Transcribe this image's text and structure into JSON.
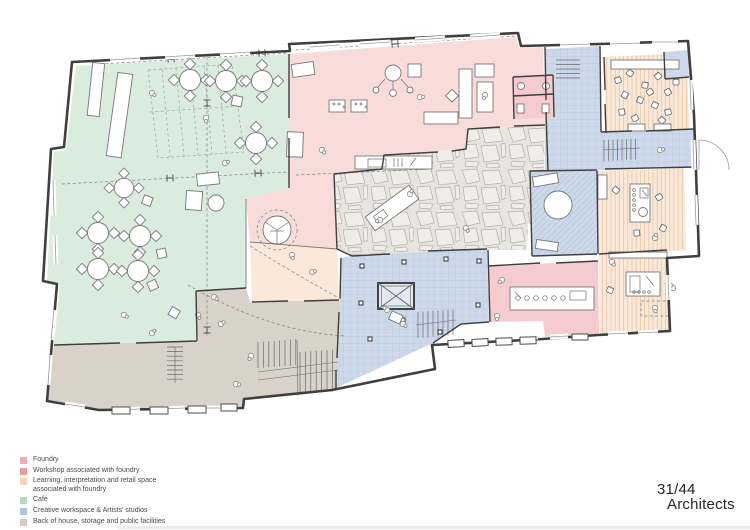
{
  "credit": {
    "line1": "31/44",
    "line2": "Architects"
  },
  "legend": {
    "items": [
      {
        "label": "Foundry",
        "color": "#efadad"
      },
      {
        "label": "Workshop associated with foundry",
        "color": "#e79e9e"
      },
      {
        "label": "Learning, interpretation and retail space",
        "label2": "associated with foundry",
        "color": "#f6d3ba"
      },
      {
        "label": "Café",
        "color": "#b4dabd"
      },
      {
        "label": "Creative workspace & Artists' studios",
        "color": "#adc5df"
      },
      {
        "label": "Back of house, storage and public facilities",
        "color": "#d3cdc1"
      }
    ]
  },
  "colors": {
    "wall": "#3f3f3f",
    "furniture-line": "#777777",
    "zone-cafe": "#daecdd",
    "zone-foundry": "#f8dcda",
    "zone-foundry-dark": "#f5cbd0",
    "zone-learning": "#fae8d8",
    "zone-studio": "#cdd9ea",
    "zone-boh": "#d8d2c9",
    "zone-stone": "#e7e5df",
    "stone-line": "#b3b0a8",
    "stripe-line": "#ddb18c",
    "tile-line": "#a3b7d1",
    "text": "#4a4a4a"
  }
}
